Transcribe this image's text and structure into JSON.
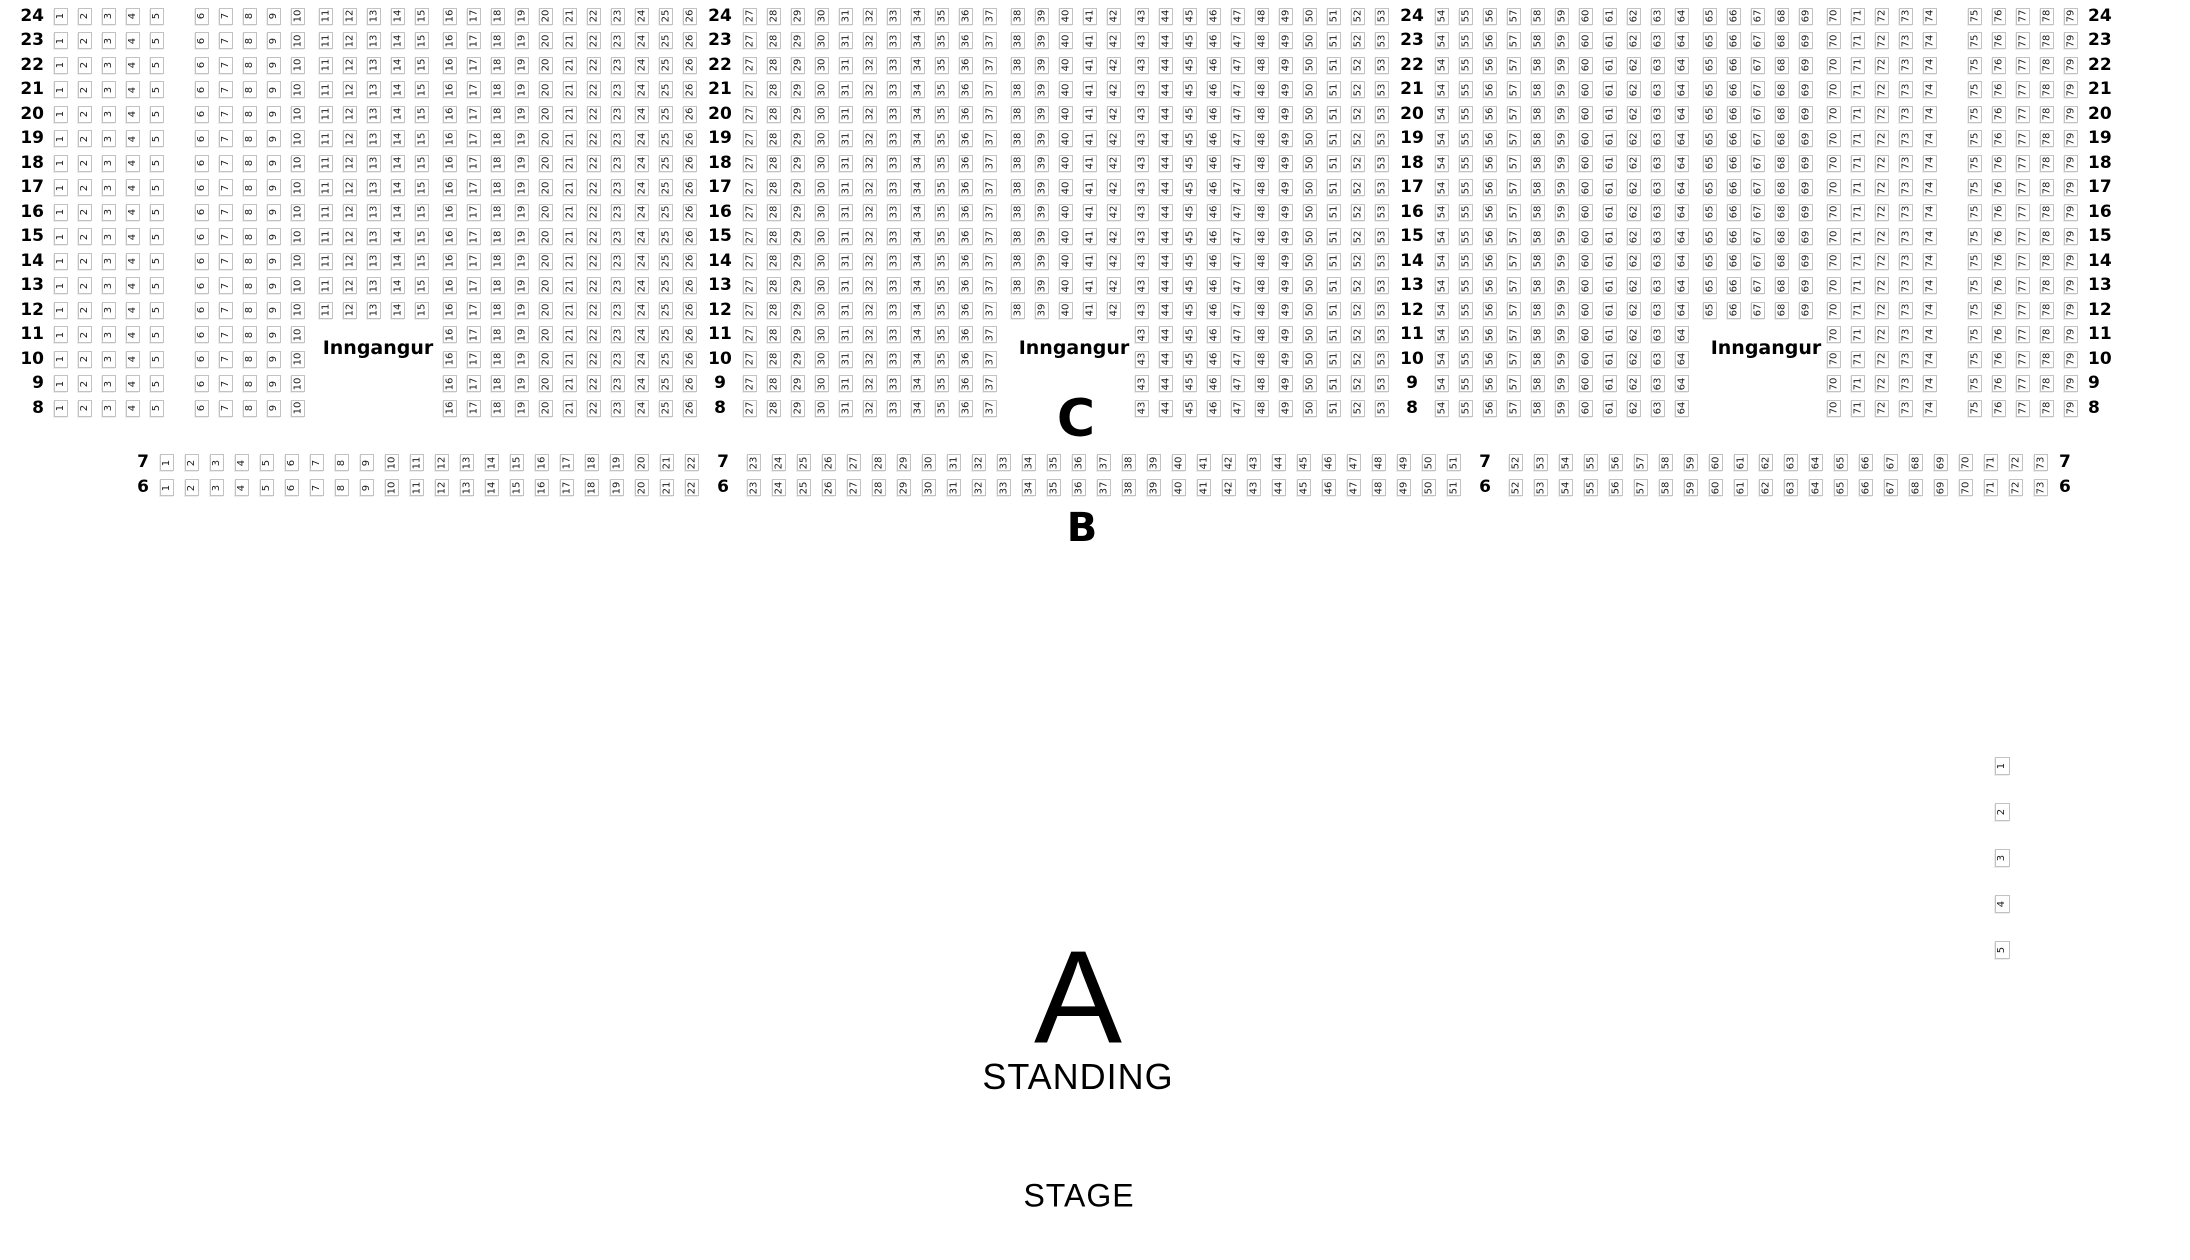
{
  "labels": {
    "entrance": "Inngangur",
    "section_c": "C",
    "section_b": "B",
    "section_a": "A",
    "standing": "STANDING",
    "stage": "STAGE"
  },
  "colors": {
    "seat_border": "#c2c2c2",
    "seat_background": "#ffffff",
    "text": "#000000"
  },
  "section_c": {
    "rows": [
      24,
      23,
      22,
      21,
      20,
      19,
      18,
      17,
      16,
      15,
      14,
      13,
      12,
      11,
      10,
      9,
      8
    ],
    "entrance_rows": [
      11,
      10,
      9,
      8
    ],
    "layout": [
      {
        "t": "label"
      },
      {
        "t": "seats",
        "a": 1,
        "b": 5
      },
      {
        "t": "aisle"
      },
      {
        "t": "seats",
        "a": 6,
        "b": 10
      },
      {
        "t": "entrance",
        "a": 11,
        "b": 15
      },
      {
        "t": "seats",
        "a": 16,
        "b": 26
      },
      {
        "t": "label"
      },
      {
        "t": "seats",
        "a": 27,
        "b": 37
      },
      {
        "t": "entrance",
        "a": 38,
        "b": 42
      },
      {
        "t": "seats",
        "a": 43,
        "b": 53
      },
      {
        "t": "label"
      },
      {
        "t": "seats",
        "a": 54,
        "b": 64
      },
      {
        "t": "entrance",
        "a": 65,
        "b": 69
      },
      {
        "t": "seats",
        "a": 70,
        "b": 74
      },
      {
        "t": "aisle"
      },
      {
        "t": "seats",
        "a": 75,
        "b": 79
      },
      {
        "t": "label"
      }
    ]
  },
  "section_b": {
    "rows": [
      7,
      6
    ],
    "entrance_rows": [],
    "layout": [
      {
        "t": "label"
      },
      {
        "t": "seats",
        "a": 1,
        "b": 22
      },
      {
        "t": "label"
      },
      {
        "t": "seats",
        "a": 23,
        "b": 51
      },
      {
        "t": "label"
      },
      {
        "t": "seats",
        "a": 52,
        "b": 73
      },
      {
        "t": "label"
      }
    ]
  },
  "side_seats": [
    1,
    2,
    3,
    4,
    5
  ]
}
